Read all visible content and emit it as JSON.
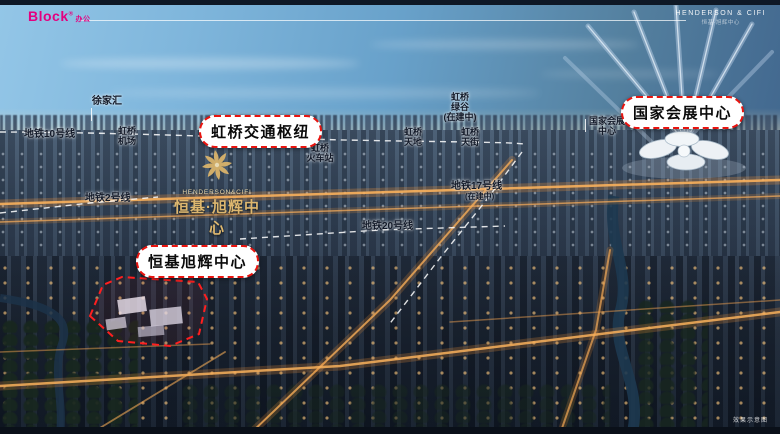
{
  "header": {
    "block_logo": "Block",
    "block_logo_reg": "®",
    "block_logo_sub": "办公",
    "brand_line1": "HENDERSON & CIFI",
    "brand_line2": "恒基·旭辉中心"
  },
  "callouts": {
    "hub": "虹桥交通枢纽",
    "necc": "国家会展中心",
    "project": "恒基旭辉中心"
  },
  "labels": {
    "xujiahui": "徐家汇",
    "line10": "地铁10号线",
    "airport_l1": "虹桥",
    "airport_l2": "机场",
    "line2": "地铁2号线",
    "railway_l1": "虹桥",
    "railway_l2": "火车站",
    "tiandi_l1": "虹桥",
    "tiandi_l2": "天地",
    "greenvalley_l1": "虹桥",
    "greenvalley_l2": "绿谷",
    "greenvalley_l3": "(在建中)",
    "tianjie_l1": "虹桥",
    "tianjie_l2": "天街",
    "line17": "地铁17号线",
    "line17_note": "(在建中)",
    "line20": "地铁20号线",
    "necc_small_l1": "国家会展",
    "necc_small_l2": "中心"
  },
  "project_logo": {
    "en": "HENDERSON&CIFI",
    "cn": "恒基·旭辉中心"
  },
  "footer": {
    "disclaimer": "效果示意图"
  },
  "colors": {
    "callout_red": "#e8140f",
    "logo_magenta": "#e4007f",
    "gold": "#ddb76f",
    "sky_blue": "#68a1ca"
  }
}
